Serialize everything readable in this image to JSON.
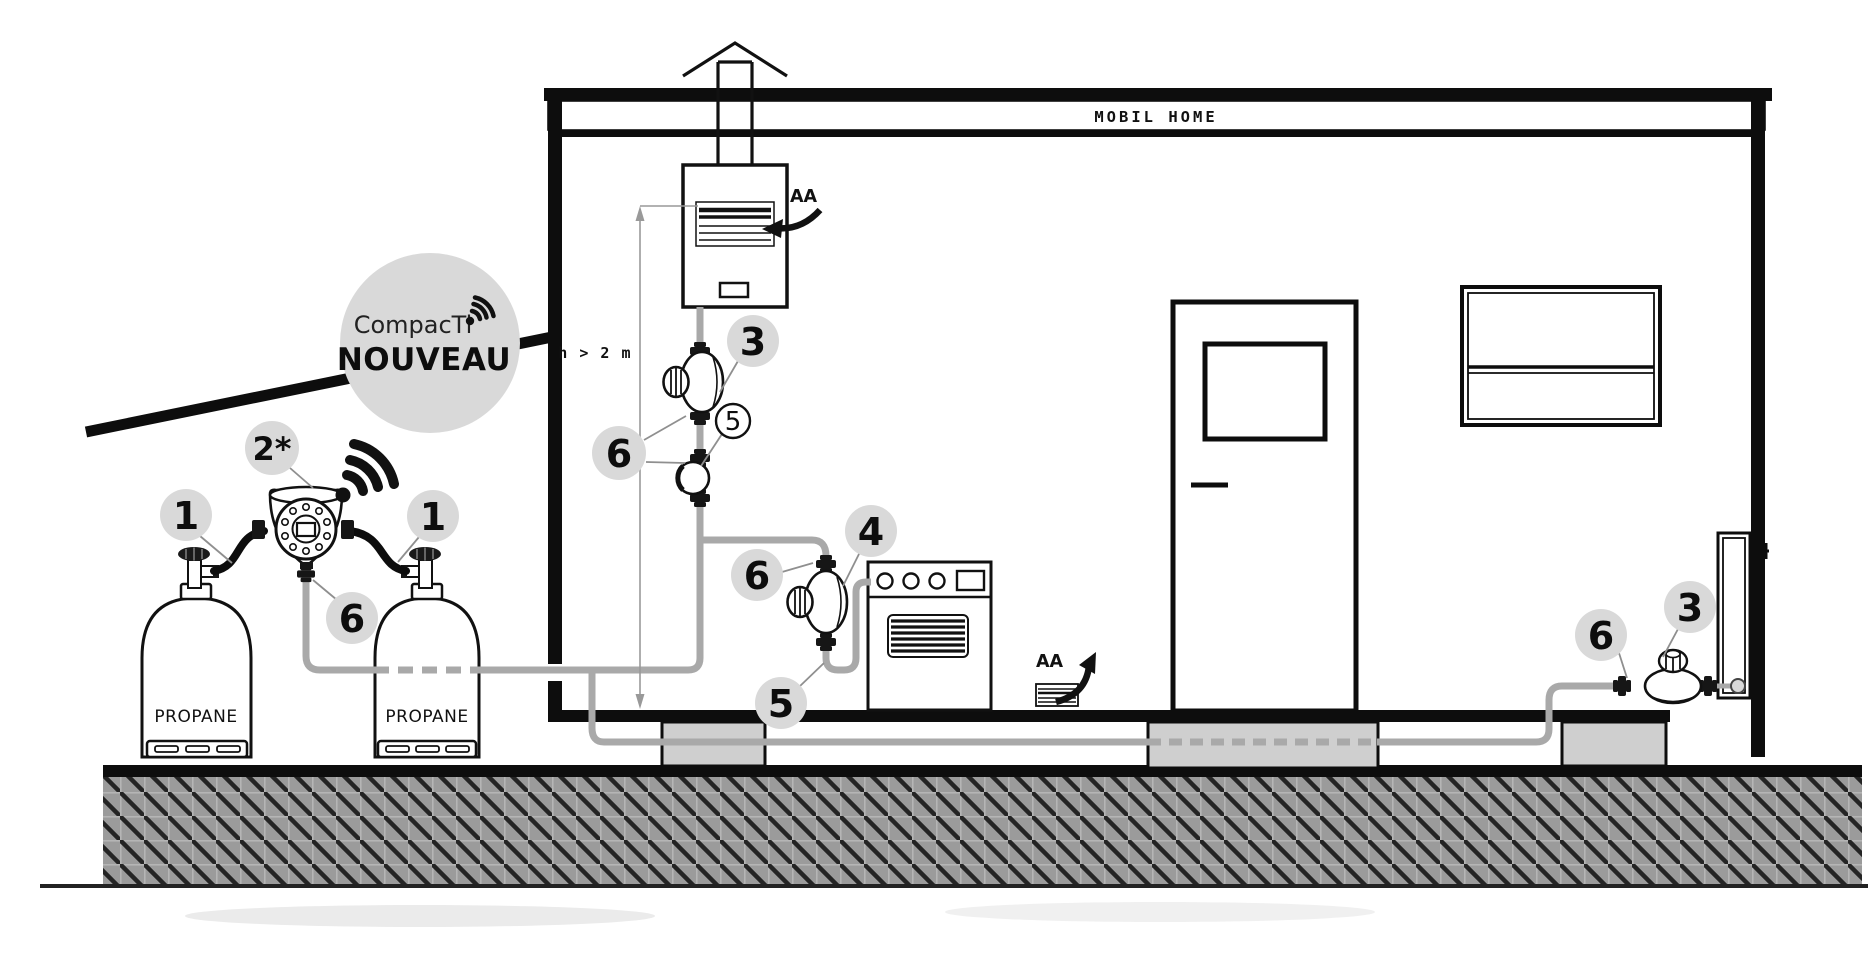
{
  "diagram": {
    "home_label": "MOBIL HOME",
    "badge": {
      "brand": "CompacTi",
      "banner": "NOUVEAU"
    },
    "tanks": {
      "left": "PROPANE",
      "right": "PROPANE"
    },
    "dimension_label": "h > 2 m",
    "air_vents": {
      "heater": "AA",
      "floor": "AA"
    },
    "callouts": {
      "hose_left": "1",
      "hose_right": "1",
      "inverter": "2*",
      "inverter_outlet_fitting": "6",
      "heater_regulator": "3",
      "heater_shutoff_valve": "5",
      "heater_fittings": "6",
      "stove_regulator_fitting": "6",
      "stove_connection": "4",
      "stove_hose": "5",
      "radiator_fitting": "6",
      "radiator_regulator": "3"
    },
    "colors": {
      "callout_bg": "#d9d9d9",
      "badge_bg": "#d9d9d9",
      "pipe": "#a9a9a9",
      "ink": "#111111",
      "block": "#cfcfcf"
    }
  }
}
